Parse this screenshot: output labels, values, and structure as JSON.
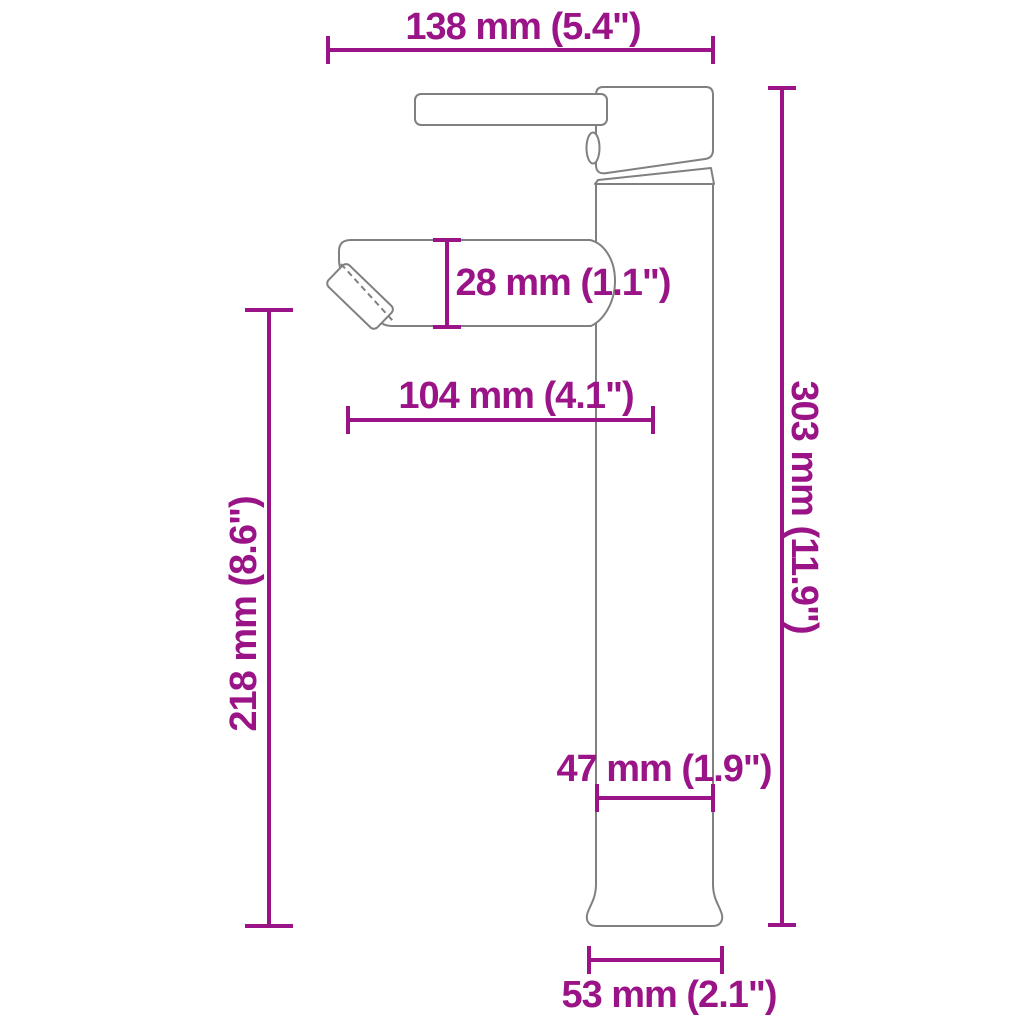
{
  "colors": {
    "dimension": "#9B1487",
    "outline": "#808080",
    "background": "#FFFFFF"
  },
  "dimensions": {
    "top_width": {
      "label": "138 mm (5.4\")"
    },
    "spout_height": {
      "label": "28 mm (1.1\")"
    },
    "spout_reach": {
      "label": "104 mm (4.1\")"
    },
    "spout_clearance": {
      "label": "218 mm (8.6\")"
    },
    "total_height": {
      "label": "303 mm (11.9\")"
    },
    "body_width": {
      "label": "47 mm (1.9\")"
    },
    "base_width": {
      "label": "53 mm (2.1\")"
    }
  }
}
